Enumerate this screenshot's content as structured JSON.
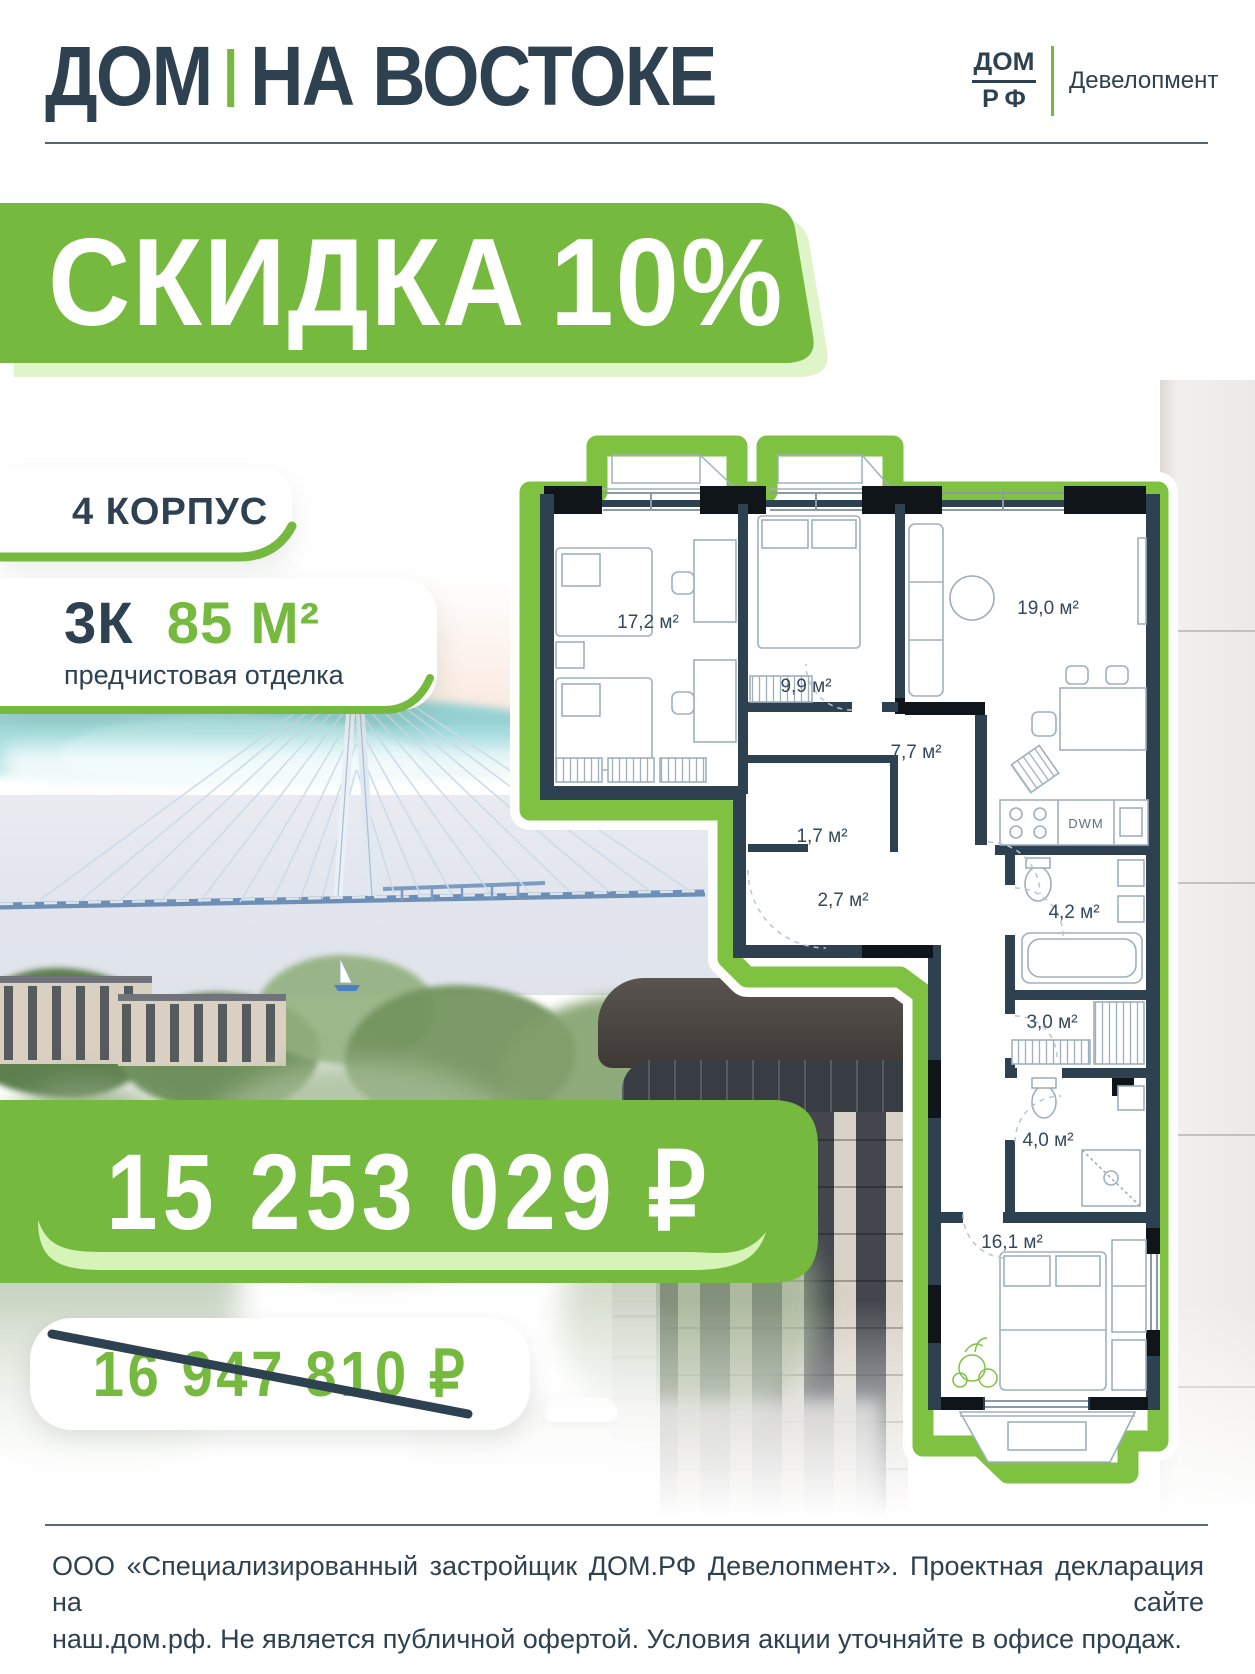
{
  "colors": {
    "green": "#76B93F",
    "plan_green": "#7FC242",
    "navy": "#2E4150",
    "pale_green": "#D6F3B8",
    "shadow_green": "#DFF4C8"
  },
  "header": {
    "title_main": "ДОМ",
    "title_rest": "НА ВОСТОКЕ",
    "logo_top": "ДОМ",
    "logo_bottom": "РФ",
    "logo_label": "Девелопмент"
  },
  "promo": {
    "discount_text": "СКИДКА",
    "discount_value": "10%"
  },
  "offer": {
    "building": "4 КОРПУС",
    "layout": "3К",
    "area": "85 М²",
    "finish": "предчистовая отделка",
    "price_new": "15 253 029 ₽",
    "price_old": "16 947 810 ₽"
  },
  "floor_plan": {
    "areas": [
      "17,2 м²",
      "9,9 м²",
      "19,0 м²",
      "7,7 м²",
      "1,7 м²",
      "2,7 м²",
      "4,2 м²",
      "3,0 м²",
      "4,0 м²",
      "16,1 м²"
    ],
    "appliance_label": "DWM"
  },
  "footer": {
    "line1": "ООО «Специализированный застройщик ДОМ.РФ Девелопмент». Проектная декларация на сайте",
    "line2": "наш.дом.рф. Не является публичной офертой. Условия акции уточняйте в офисе продаж."
  }
}
